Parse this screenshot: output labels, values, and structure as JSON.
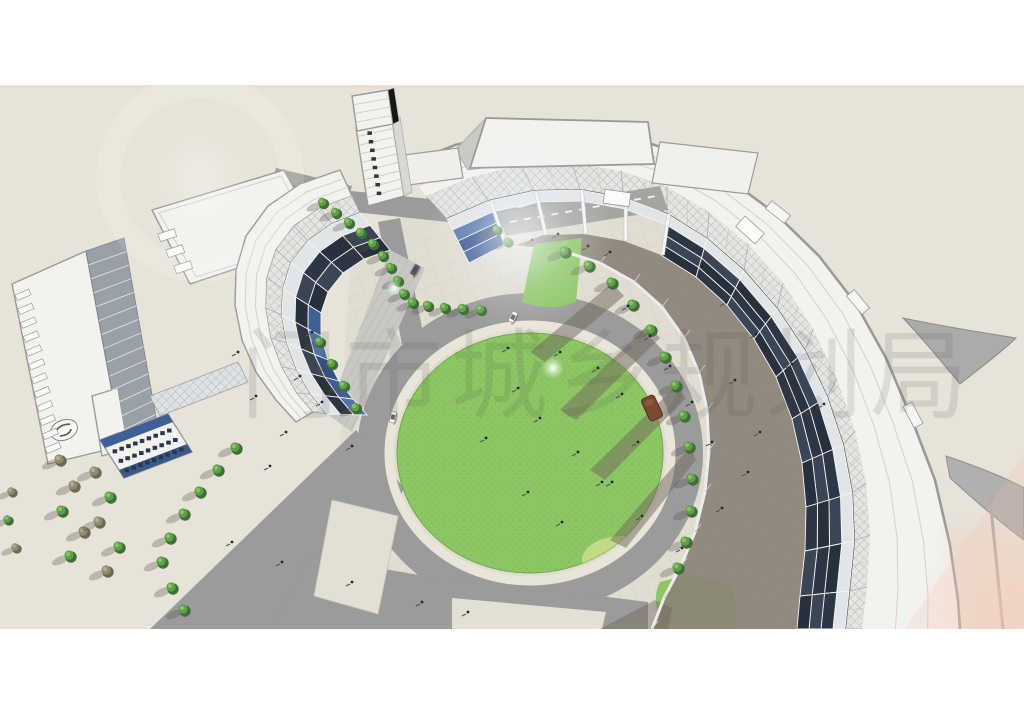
{
  "watermark": {
    "text": "门市城乡规划局",
    "color": "#4a4a4a",
    "opacity": 0.13,
    "font_size": 98
  },
  "palette": {
    "page_bg": "#ffffff",
    "ground": "#e7e3d8",
    "plaza": "#ded9cc",
    "road": "#9b9b9b",
    "road_dark": "#8f8f8f",
    "island": "#e4dfd3",
    "lawn": "#8cc763",
    "lawn_light": "#cfe08e",
    "sidewalk": "#e9e5d9",
    "shadow": "#8b8276",
    "shadow_dark": "#6f685c",
    "bldg": "#f2f2ef",
    "trim": "#9a9a9a",
    "truss": "#e5e5e2",
    "glass_dark": "#2d3644",
    "glass_blue": "#3f5f97",
    "spandrel": "#e2e5e8",
    "tree_green": "#5f9e4a",
    "tree_green_dark": "#3e6f33",
    "tree_olive": "#908b6f",
    "flare_pink": "#f4c0ae",
    "wm": "#4a4a4a"
  },
  "scene": {
    "render_area": {
      "top": 85,
      "bottom": 629,
      "width": 1024
    },
    "lawn": {
      "cx": 530,
      "cy": 453,
      "rx": 133,
      "ry": 120
    },
    "trees": [
      [
        323,
        203,
        1,
        0
      ],
      [
        336,
        213,
        1,
        0
      ],
      [
        349,
        223,
        1,
        0
      ],
      [
        361,
        233,
        1,
        0
      ],
      [
        373,
        244,
        1,
        0
      ],
      [
        383,
        256,
        1,
        0
      ],
      [
        391,
        268,
        1,
        0
      ],
      [
        398,
        281,
        1,
        0
      ],
      [
        404,
        294,
        1,
        0
      ],
      [
        413,
        303,
        1,
        0
      ],
      [
        428,
        306,
        1,
        0
      ],
      [
        445,
        308,
        1,
        0
      ],
      [
        463,
        309,
        1,
        0
      ],
      [
        481,
        310,
        1,
        0
      ],
      [
        497,
        230,
        0.9,
        0
      ],
      [
        508,
        242,
        0.9,
        0
      ],
      [
        320,
        342,
        1,
        0
      ],
      [
        332,
        364,
        1,
        0
      ],
      [
        344,
        386,
        1,
        0
      ],
      [
        356,
        408,
        1,
        0
      ],
      [
        565,
        252,
        1.1,
        0
      ],
      [
        589,
        266,
        1.1,
        0
      ],
      [
        612,
        283,
        1.1,
        0
      ],
      [
        633,
        305,
        1.1,
        0
      ],
      [
        651,
        330,
        1.1,
        0
      ],
      [
        665,
        357,
        1.1,
        0
      ],
      [
        676,
        386,
        1.1,
        0
      ],
      [
        684,
        416,
        1.1,
        0
      ],
      [
        689,
        447,
        1.1,
        0
      ],
      [
        692,
        479,
        1.1,
        0
      ],
      [
        691,
        511,
        1.1,
        0
      ],
      [
        686,
        542,
        1.1,
        0
      ],
      [
        678,
        568,
        1.1,
        0
      ],
      [
        236,
        448,
        1.1,
        0
      ],
      [
        218,
        470,
        1.1,
        0
      ],
      [
        200,
        492,
        1.1,
        0
      ],
      [
        184,
        514,
        1.1,
        0
      ],
      [
        170,
        538,
        1.1,
        0
      ],
      [
        162,
        562,
        1.1,
        0
      ],
      [
        172,
        588,
        1.1,
        0
      ],
      [
        184,
        610,
        1.1,
        0
      ],
      [
        60,
        460,
        1.1,
        1
      ],
      [
        74,
        486,
        1.1,
        1
      ],
      [
        62,
        511,
        1.1,
        0
      ],
      [
        84,
        532,
        1.1,
        1
      ],
      [
        70,
        556,
        1.1,
        0
      ],
      [
        95,
        472,
        1.1,
        1
      ],
      [
        110,
        497,
        1.1,
        0
      ],
      [
        99,
        522,
        1.1,
        1
      ],
      [
        119,
        547,
        1.1,
        0
      ],
      [
        107,
        571,
        1.1,
        1
      ],
      [
        12,
        492,
        0.9,
        1
      ],
      [
        8,
        520,
        0.9,
        0
      ],
      [
        16,
        548,
        0.9,
        1
      ]
    ],
    "people": [
      [
        508,
        348
      ],
      [
        560,
        352
      ],
      [
        598,
        368
      ],
      [
        622,
        394
      ],
      [
        540,
        418
      ],
      [
        578,
        452
      ],
      [
        612,
        482
      ],
      [
        528,
        492
      ],
      [
        562,
        522
      ],
      [
        486,
        438
      ],
      [
        638,
        442
      ],
      [
        518,
        388
      ],
      [
        628,
        306
      ],
      [
        650,
        336
      ],
      [
        670,
        366
      ],
      [
        692,
        402
      ],
      [
        712,
        442
      ],
      [
        602,
        482
      ],
      [
        642,
        516
      ],
      [
        682,
        548
      ],
      [
        722,
        508
      ],
      [
        748,
        472
      ],
      [
        760,
        432
      ],
      [
        735,
        380
      ],
      [
        300,
        376
      ],
      [
        322,
        402
      ],
      [
        286,
        432
      ],
      [
        352,
        446
      ],
      [
        270,
        466
      ],
      [
        312,
        332
      ],
      [
        256,
        396
      ],
      [
        238,
        352
      ],
      [
        558,
        234
      ],
      [
        588,
        246
      ],
      [
        532,
        240
      ],
      [
        610,
        252
      ],
      [
        232,
        542
      ],
      [
        282,
        562
      ],
      [
        352,
        582
      ],
      [
        422,
        602
      ],
      [
        468,
        612
      ],
      [
        726,
        302
      ],
      [
        756,
        334
      ],
      [
        792,
        364
      ],
      [
        824,
        404
      ]
    ],
    "cars": [
      {
        "x": 513,
        "y": 317,
        "angle": -62,
        "color": "#f7f7f5"
      },
      {
        "x": 415,
        "y": 270,
        "angle": -60,
        "color": "#565b63"
      },
      {
        "x": 393,
        "y": 417,
        "angle": -78,
        "color": "#fafaf8"
      }
    ],
    "kiosk": {
      "x": 652,
      "y": 408,
      "angle": -25,
      "color": "#7a4a33"
    }
  }
}
